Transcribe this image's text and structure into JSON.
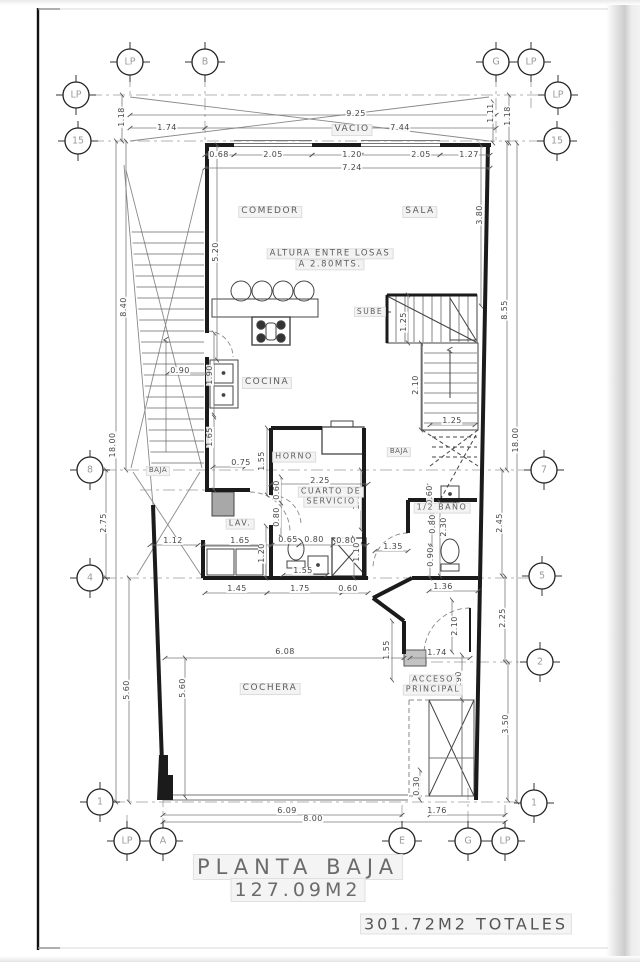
{
  "sheet": {
    "title": "PLANTA BAJA",
    "area": "127.09M2",
    "total": "301.72M2 TOTALES"
  },
  "colors": {
    "wall": "#1b1b1b",
    "thin_line": "#555555",
    "axis": "#9b9b9b",
    "dim_line": "#7a7a7a",
    "label_text": "#5d5d5d",
    "bubble_text": "#9b9b9b",
    "shade": "#a8a8a8"
  },
  "rooms": [
    {
      "text": "VACIO",
      "x": 352,
      "y": 130
    },
    {
      "text": "COMEDOR",
      "x": 270,
      "y": 212
    },
    {
      "text": "SALA",
      "x": 420,
      "y": 212
    },
    {
      "text": "ALTURA ENTRE LOSAS",
      "x": 330,
      "y": 254,
      "size": 8.5
    },
    {
      "text": "A 2.80MTS.",
      "x": 330,
      "y": 265,
      "size": 8.5
    },
    {
      "text": "SUBE",
      "x": 370,
      "y": 312,
      "size": 7.5
    },
    {
      "text": "COCINA",
      "x": 267,
      "y": 383
    },
    {
      "text": "HORNO",
      "x": 294,
      "y": 457,
      "size": 8
    },
    {
      "text": "BAJA",
      "x": 158,
      "y": 471,
      "small": true
    },
    {
      "text": "BAJA",
      "x": 399,
      "y": 452,
      "small": true
    },
    {
      "text": "CUARTO DE",
      "x": 331,
      "y": 492,
      "size": 8
    },
    {
      "text": "SERVICIO",
      "x": 331,
      "y": 502,
      "size": 8
    },
    {
      "text": "LAV.",
      "x": 240,
      "y": 524,
      "size": 8
    },
    {
      "text": "1/2 BAÑO",
      "x": 442,
      "y": 508,
      "size": 8
    },
    {
      "text": "COCHERA",
      "x": 270,
      "y": 689
    },
    {
      "text": "ACCESO",
      "x": 433,
      "y": 680,
      "size": 8
    },
    {
      "text": "PRINCIPAL",
      "x": 433,
      "y": 690,
      "size": 8
    }
  ],
  "dims": [
    {
      "text": "1.74",
      "x": 167,
      "y": 128
    },
    {
      "text": "9.25",
      "x": 356,
      "y": 114
    },
    {
      "text": "7.44",
      "x": 400,
      "y": 128
    },
    {
      "text": "1.18",
      "x": 122,
      "y": 117,
      "rot": 90
    },
    {
      "text": "1.11",
      "x": 491,
      "y": 113,
      "rot": 90
    },
    {
      "text": "1.18",
      "x": 508,
      "y": 116,
      "rot": 90
    },
    {
      "text": "0.68",
      "x": 219,
      "y": 155
    },
    {
      "text": "2.05",
      "x": 273,
      "y": 155
    },
    {
      "text": "1.20",
      "x": 352,
      "y": 155
    },
    {
      "text": "2.05",
      "x": 421,
      "y": 155
    },
    {
      "text": "1.27",
      "x": 469,
      "y": 155
    },
    {
      "text": "7.24",
      "x": 352,
      "y": 168
    },
    {
      "text": "8.40",
      "x": 124,
      "y": 307,
      "rot": 90
    },
    {
      "text": "18.00",
      "x": 113,
      "y": 445,
      "rot": 90
    },
    {
      "text": "2.75",
      "x": 104,
      "y": 523,
      "rot": 90
    },
    {
      "text": "5.60",
      "x": 127,
      "y": 690,
      "rot": 90
    },
    {
      "text": "5.20",
      "x": 216,
      "y": 252,
      "rot": 90
    },
    {
      "text": "3.80",
      "x": 480,
      "y": 215,
      "rot": 90
    },
    {
      "text": "8.55",
      "x": 505,
      "y": 310,
      "rot": 90
    },
    {
      "text": "18.00",
      "x": 516,
      "y": 440,
      "rot": 90
    },
    {
      "text": "2.45",
      "x": 500,
      "y": 523,
      "rot": 90
    },
    {
      "text": "2.25",
      "x": 503,
      "y": 618,
      "rot": 90
    },
    {
      "text": "3.50",
      "x": 506,
      "y": 724,
      "rot": 90
    },
    {
      "text": "1.25",
      "x": 404,
      "y": 322,
      "rot": 90
    },
    {
      "text": "2.10",
      "x": 416,
      "y": 385,
      "rot": 90
    },
    {
      "text": "1.25",
      "x": 452,
      "y": 421
    },
    {
      "text": "0.90",
      "x": 180,
      "y": 371
    },
    {
      "text": "1.90",
      "x": 210,
      "y": 375,
      "rot": 90
    },
    {
      "text": "1.65",
      "x": 210,
      "y": 437,
      "rot": 90
    },
    {
      "text": "0.75",
      "x": 241,
      "y": 463
    },
    {
      "text": "1.55",
      "x": 262,
      "y": 461,
      "rot": 90
    },
    {
      "text": "0.60",
      "x": 277,
      "y": 490,
      "rot": 90
    },
    {
      "text": "0.80",
      "x": 277,
      "y": 517,
      "rot": 90
    },
    {
      "text": "2.25",
      "x": 320,
      "y": 481
    },
    {
      "text": "1.40",
      "x": 357,
      "y": 500,
      "rot": 90
    },
    {
      "text": "1.12",
      "x": 173,
      "y": 541
    },
    {
      "text": "1.65",
      "x": 240,
      "y": 541
    },
    {
      "text": "1.20",
      "x": 262,
      "y": 553,
      "rot": 90
    },
    {
      "text": "0.65",
      "x": 288,
      "y": 540
    },
    {
      "text": "0.80",
      "x": 314,
      "y": 540
    },
    {
      "text": "0.80",
      "x": 346,
      "y": 541
    },
    {
      "text": "1.10",
      "x": 357,
      "y": 552,
      "rot": 90
    },
    {
      "text": "1.35",
      "x": 393,
      "y": 547
    },
    {
      "text": "1.55",
      "x": 303,
      "y": 571
    },
    {
      "text": "1.45",
      "x": 237,
      "y": 589
    },
    {
      "text": "1.75",
      "x": 300,
      "y": 589
    },
    {
      "text": "0.60",
      "x": 348,
      "y": 589
    },
    {
      "text": "0.60",
      "x": 430,
      "y": 495,
      "rot": 90
    },
    {
      "text": "0.80",
      "x": 433,
      "y": 524,
      "rot": 90
    },
    {
      "text": "2.30",
      "x": 444,
      "y": 527,
      "rot": 90
    },
    {
      "text": "0.90",
      "x": 431,
      "y": 557,
      "rot": 90
    },
    {
      "text": "1.36",
      "x": 443,
      "y": 587
    },
    {
      "text": "6.08",
      "x": 285,
      "y": 652
    },
    {
      "text": "1.55",
      "x": 387,
      "y": 650,
      "rot": 90
    },
    {
      "text": "1.74",
      "x": 437,
      "y": 653
    },
    {
      "text": "2.10",
      "x": 455,
      "y": 626,
      "rot": 90
    },
    {
      "text": "0.90",
      "x": 459,
      "y": 681,
      "rot": 90
    },
    {
      "text": "5.60",
      "x": 183,
      "y": 688,
      "rot": 90
    },
    {
      "text": "0.30",
      "x": 417,
      "y": 786,
      "rot": 90
    },
    {
      "text": "6.09",
      "x": 287,
      "y": 811
    },
    {
      "text": "8.00",
      "x": 313,
      "y": 819
    },
    {
      "text": "1.76",
      "x": 437,
      "y": 811
    }
  ],
  "bubbles": [
    {
      "label": "LP",
      "x": 130,
      "y": 62
    },
    {
      "label": "B",
      "x": 205,
      "y": 62
    },
    {
      "label": "G",
      "x": 496,
      "y": 62
    },
    {
      "label": "LP",
      "x": 531,
      "y": 62
    },
    {
      "label": "LP",
      "x": 76,
      "y": 95
    },
    {
      "label": "15",
      "x": 78,
      "y": 141
    },
    {
      "label": "8",
      "x": 90,
      "y": 470
    },
    {
      "label": "4",
      "x": 90,
      "y": 578
    },
    {
      "label": "1",
      "x": 100,
      "y": 802
    },
    {
      "label": "LP",
      "x": 558,
      "y": 95
    },
    {
      "label": "15",
      "x": 557,
      "y": 141
    },
    {
      "label": "7",
      "x": 544,
      "y": 470
    },
    {
      "label": "5",
      "x": 542,
      "y": 576
    },
    {
      "label": "2",
      "x": 540,
      "y": 662
    },
    {
      "label": "1",
      "x": 534,
      "y": 803
    },
    {
      "label": "LP",
      "x": 127,
      "y": 841
    },
    {
      "label": "A",
      "x": 163,
      "y": 841
    },
    {
      "label": "E",
      "x": 402,
      "y": 841
    },
    {
      "label": "G",
      "x": 468,
      "y": 841
    },
    {
      "label": "LP",
      "x": 505,
      "y": 841
    }
  ]
}
